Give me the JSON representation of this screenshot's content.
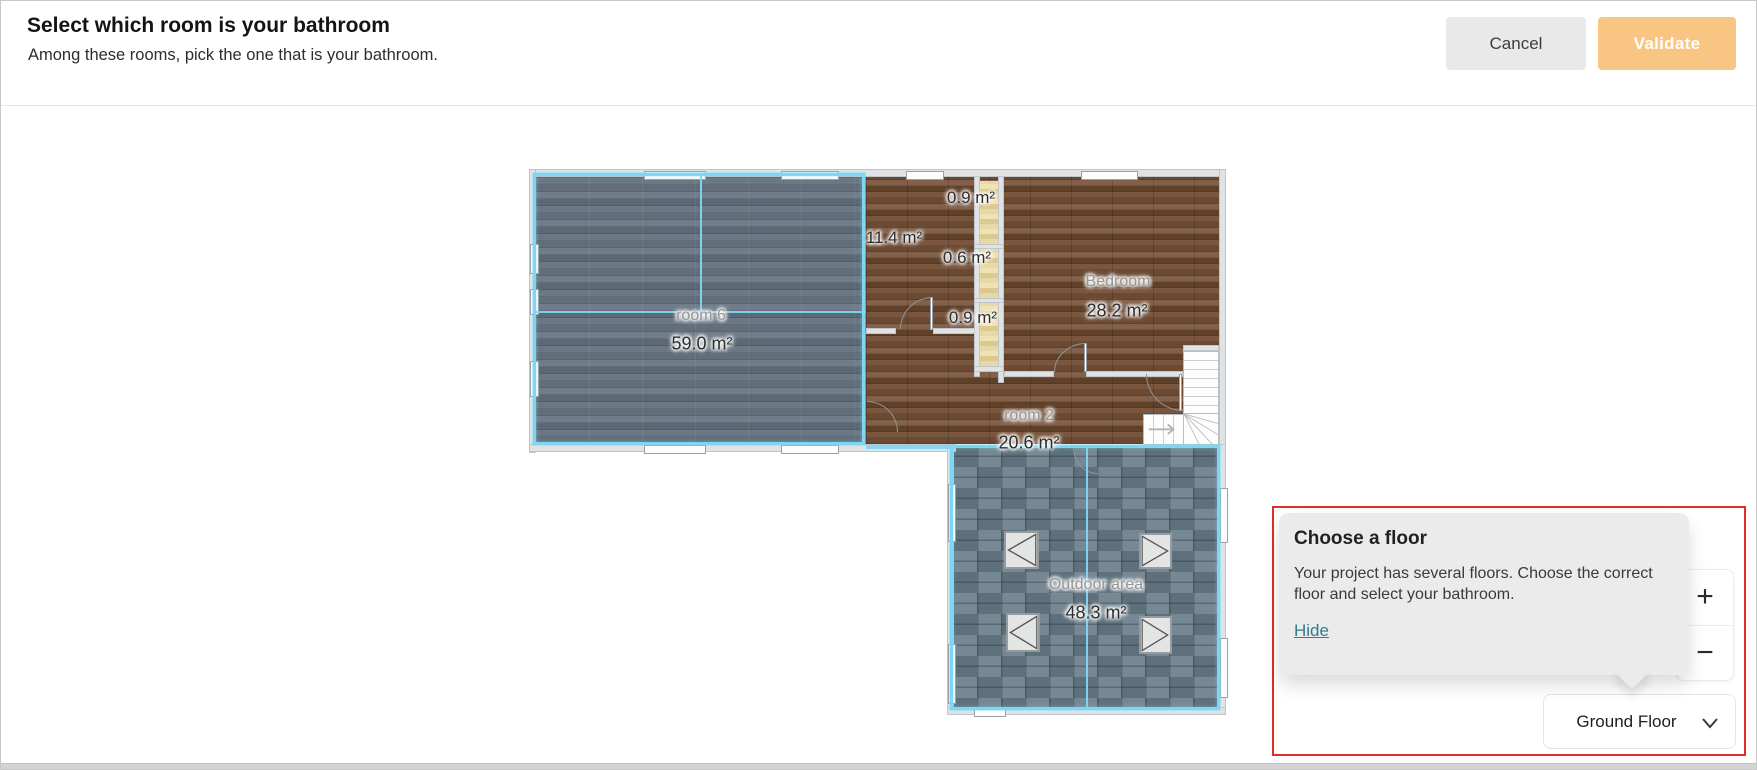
{
  "header": {
    "title": "Select which room is your bathroom",
    "subtitle": "Among these rooms, pick the one that is your bathroom.",
    "cancel_label": "Cancel",
    "validate_label": "Validate"
  },
  "plan": {
    "rooms": {
      "room6": {
        "name": "room 6",
        "area": "59.0 m²"
      },
      "hall": {
        "area": "11.4 m²"
      },
      "closet_top": {
        "area": "0.9 m²"
      },
      "closet_mid": {
        "area": "0.6 m²"
      },
      "closet_bottom": {
        "area": "0.9 m²"
      },
      "bedroom": {
        "name": "Bedroom",
        "area": "28.2 m²"
      },
      "room2": {
        "name": "room 2",
        "area": "20.6 m²"
      },
      "outdoor": {
        "name": "Outdoor area",
        "area": "48.3 m²"
      }
    }
  },
  "tooltip": {
    "title": "Choose a floor",
    "body": "Your project has several floors. Choose the correct floor and select your bathroom.",
    "hide_label": "Hide"
  },
  "zoom_controls": {
    "zoom_in": "+",
    "zoom_out": "−"
  },
  "floor_selector": {
    "value": "Ground Floor"
  },
  "colors": {
    "validate_accent": "#f9c583",
    "selection_cyan": "#7ed6f2",
    "highlight_red": "#dc2f27",
    "link_teal": "#2e7d8c"
  }
}
